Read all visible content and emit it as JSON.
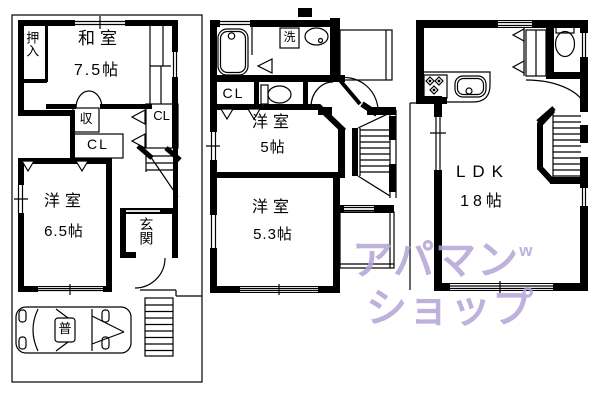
{
  "floorplan": {
    "floor1": {
      "oshiire": "押入",
      "washitsu": {
        "label": "和室",
        "size": "7.5帖"
      },
      "storage": "収",
      "closet_hall": "CL",
      "closet_right": "CL",
      "yoshitsu": {
        "label": "洋室",
        "size": "6.5帖"
      },
      "genkan": "玄関",
      "parking": {
        "car_label": "普"
      }
    },
    "floor2": {
      "laundry": "洗",
      "closet": "CL",
      "bedroom1": {
        "label": "洋室",
        "size": "5帖"
      },
      "bedroom2": {
        "label": "洋室",
        "size": "5.3帖"
      }
    },
    "floor3": {
      "ldk": {
        "label": "LDK",
        "size": "18帖"
      }
    }
  },
  "watermark": {
    "line1": "アパマン",
    "superscript": "w",
    "line2": "ショップ",
    "color": "#b3a4d6"
  },
  "colors": {
    "line": "#000000",
    "background": "#ffffff"
  }
}
